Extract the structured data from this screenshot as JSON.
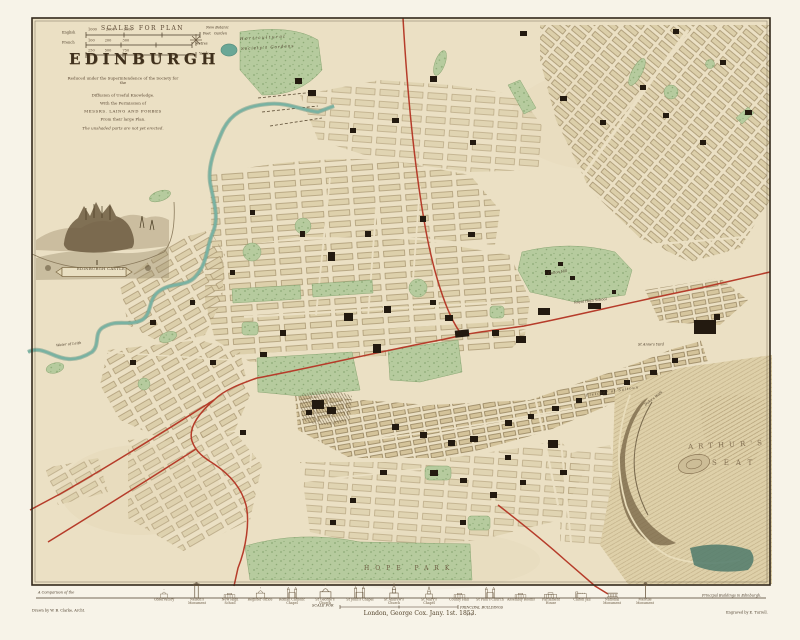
{
  "colors": {
    "paper_margin": "#f7f3e8",
    "paper_map": "#ebe0c4",
    "park_green": "#b6cb9e",
    "water_teal": "#79b2a2",
    "railway_red": "#b63c2a",
    "building_black": "#231a10",
    "frame_brown": "#33291c",
    "engraving_sepia": "#6b5a42"
  },
  "title_block": {
    "scales_heading": "SCALES FOR PLAN",
    "title": "EDINBURGH",
    "subtitle": [
      "Reduced under the Superintendence of the Society for the",
      "Diffusion of Useful Knowledge.",
      "With the Permission of",
      "MESSRS. LAING AND FORBES",
      "From their large Plan.",
      "The unshaded parts are not yet erected."
    ],
    "scale_rows": [
      {
        "left": "English",
        "ticks": "1000        2000        3000",
        "right": "Feet"
      },
      {
        "left": "French",
        "ticks": "100         200          300",
        "right": "Metres"
      },
      {
        "left": "",
        "ticks": "250         500          750",
        "right": "Yards"
      }
    ]
  },
  "map_labels": {
    "new_botanic_1": "New Botanic",
    "new_botanic_2": "Garden",
    "horticultural_1": "Horticultural",
    "horticultural_2": "Society's Gardens",
    "vignette_ribbon": "EDINBURGH CASTLE",
    "water_of_leith": "Water of Leith",
    "calton_hill": "Calton Hill",
    "royal_high_school": "Royal High School",
    "st_annes_yard": "St Anne's Yard",
    "fletcher": "Fletcher of Saltoun",
    "dukes_walk": "Duke's Walk",
    "arthurs": "ARTHUR'S",
    "seat": "SEAT",
    "hope_park": "HOPE  PARK"
  },
  "plate": {
    "comparison_left": "A Comparison of the",
    "comparison_right": "Principal Buildings in Edinburgh.",
    "drawn_by": "Drawn by W. B. Clarke, Archt.",
    "engraved_by": "Engraved by E. Turrell.",
    "imprint": "London, George Cox.  Jany. 1st. 1853.",
    "plate_number": "170",
    "mini_scale_left": "SCALE FOR",
    "mini_scale_right": "PRINCIPAL BUILDINGS"
  },
  "frieze": {
    "buildings": [
      {
        "name": "Observatory",
        "type": "dome",
        "h": 9
      },
      {
        "name": "Nelson's Monument",
        "type": "tower",
        "h": 16
      },
      {
        "name": "New High School",
        "type": "block",
        "h": 10
      },
      {
        "name": "Register Office",
        "type": "dome",
        "h": 11
      },
      {
        "name": "Roman Catholic Chapel",
        "type": "gothic",
        "h": 12
      },
      {
        "name": "St George's Church",
        "type": "dome",
        "h": 14
      },
      {
        "name": "St John's Chapel",
        "type": "gothic",
        "h": 13
      },
      {
        "name": "St Andrew's Church",
        "type": "spire",
        "h": 15
      },
      {
        "name": "St Mary's Chapel",
        "type": "spire",
        "h": 12
      },
      {
        "name": "County Hall",
        "type": "block",
        "h": 10
      },
      {
        "name": "St Paul's Church",
        "type": "gothic",
        "h": 12
      },
      {
        "name": "Assembly Rooms",
        "type": "block",
        "h": 10
      },
      {
        "name": "Parliament House",
        "type": "block",
        "h": 11
      },
      {
        "name": "Calton Jail",
        "type": "castle",
        "h": 11
      },
      {
        "name": "National Monument",
        "type": "columns",
        "h": 10
      },
      {
        "name": "Melville Monument",
        "type": "column",
        "h": 16
      }
    ]
  }
}
